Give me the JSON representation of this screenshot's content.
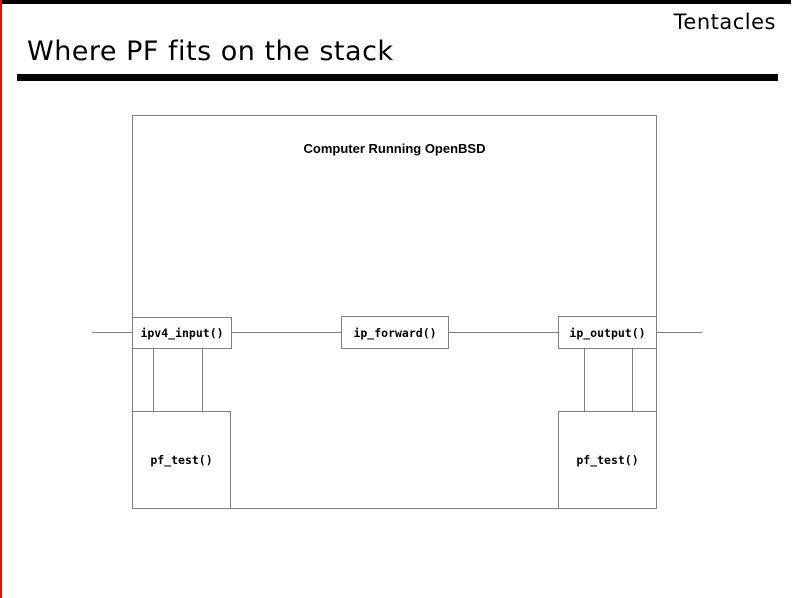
{
  "slide": {
    "logo_text": "Tentacles",
    "title": "Where PF fits on the stack",
    "colors": {
      "accent_red": "#ff0000",
      "frame_black": "#000000",
      "diagram_line_gray": "#808080",
      "background": "#ffffff"
    },
    "diagram": {
      "container_label": "Computer Running OpenBSD",
      "stack_boxes": [
        {
          "label": "ipv4_input()"
        },
        {
          "label": "ip_forward()"
        },
        {
          "label": "ip_output()"
        }
      ],
      "pf_boxes": [
        {
          "label": "pf_test()"
        },
        {
          "label": "pf_test()"
        }
      ]
    }
  }
}
